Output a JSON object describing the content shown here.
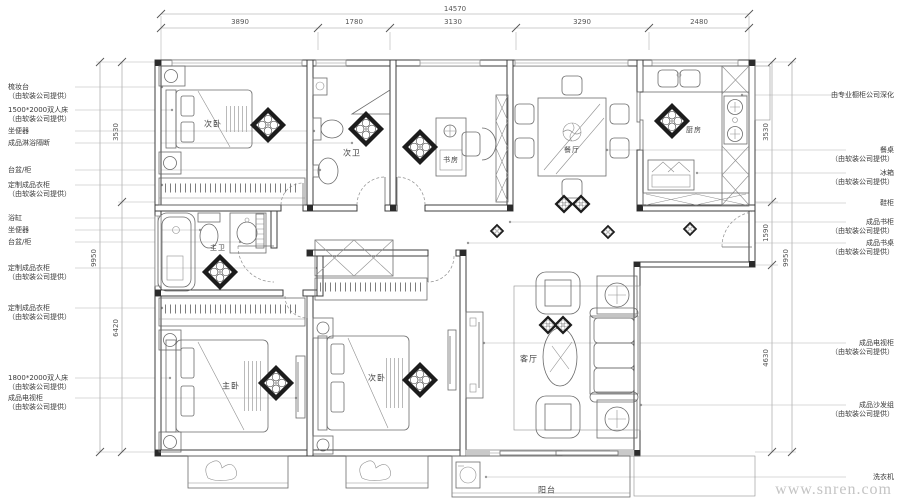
{
  "plan": {
    "rooms": {
      "bed2_top": "次卧",
      "bath2": "次卫",
      "study": "书房",
      "dining": "餐厅",
      "kitchen": "厨房",
      "master_bath": "主卫",
      "master_bed": "主卧",
      "bed2_bottom": "次卧",
      "living": "客厅",
      "balcony": "阳台"
    },
    "dims": {
      "top_total": "14570",
      "top": [
        "3890",
        "1780",
        "3130",
        "3290",
        "2480"
      ],
      "left": [
        "3530",
        "6420"
      ],
      "left_total": "9950",
      "right": [
        "3530",
        "1590",
        "4630"
      ],
      "right_total": "9950"
    },
    "left_labels": [
      {
        "text": "梳妆台",
        "sub": "（由软装公司提供）"
      },
      {
        "text": "1500*2000双人床",
        "sub": "（由软装公司提供）"
      },
      {
        "text": "坐便器",
        "sub": ""
      },
      {
        "text": "成品淋浴隔断",
        "sub": ""
      },
      {
        "text": "台盆/柜",
        "sub": ""
      },
      {
        "text": "定制成品衣柜",
        "sub": "（由软装公司提供）"
      },
      {
        "text": "浴缸",
        "sub": ""
      },
      {
        "text": "坐便器",
        "sub": ""
      },
      {
        "text": "台盆/柜",
        "sub": ""
      },
      {
        "text": "定制成品衣柜",
        "sub": "（由软装公司提供）"
      },
      {
        "text": "定制成品衣柜",
        "sub": "（由软装公司提供）"
      },
      {
        "text": "1800*2000双人床",
        "sub": "（由软装公司提供）"
      },
      {
        "text": "成品电视柜",
        "sub": "（由软装公司提供）"
      }
    ],
    "right_labels": [
      {
        "text": "由专业橱柜公司深化",
        "sub": ""
      },
      {
        "text": "餐桌",
        "sub": "（由软装公司提供）"
      },
      {
        "text": "冰箱",
        "sub": "（由软装公司提供）"
      },
      {
        "text": "鞋柜",
        "sub": ""
      },
      {
        "text": "成品书柜",
        "sub": "（由软装公司提供）"
      },
      {
        "text": "成品书桌",
        "sub": "（由软装公司提供）"
      },
      {
        "text": "成品电视柜",
        "sub": "（由软装公司提供）"
      },
      {
        "text": "成品沙发组",
        "sub": "（由软装公司提供）"
      },
      {
        "text": "洗衣机",
        "sub": ""
      }
    ],
    "watermark": "www.snren.com"
  }
}
